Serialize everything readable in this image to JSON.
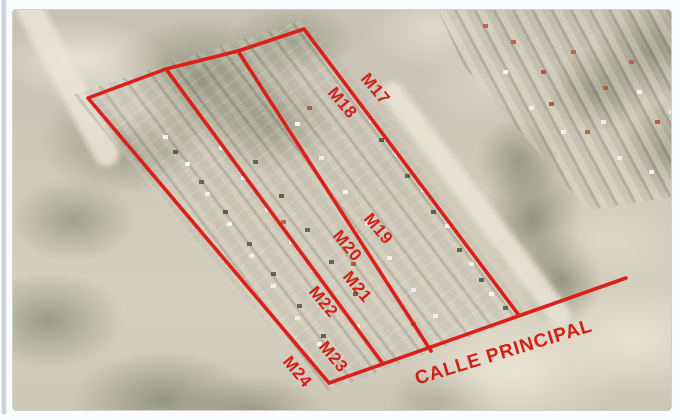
{
  "map": {
    "type": "satellite-aerial-photo",
    "description": "Aerial photo of a settlement with a red land-survey overlay: a large quadrilateral subdivided by parallel lines into block strips labeled M17 to M24, bounded below by the main street",
    "overlay_color": "#da2018",
    "block_labels": [
      "M17",
      "M18",
      "M19",
      "M20",
      "M21",
      "M22",
      "M23",
      "M24"
    ],
    "street_label": "CALLE PRINCIPAL"
  }
}
